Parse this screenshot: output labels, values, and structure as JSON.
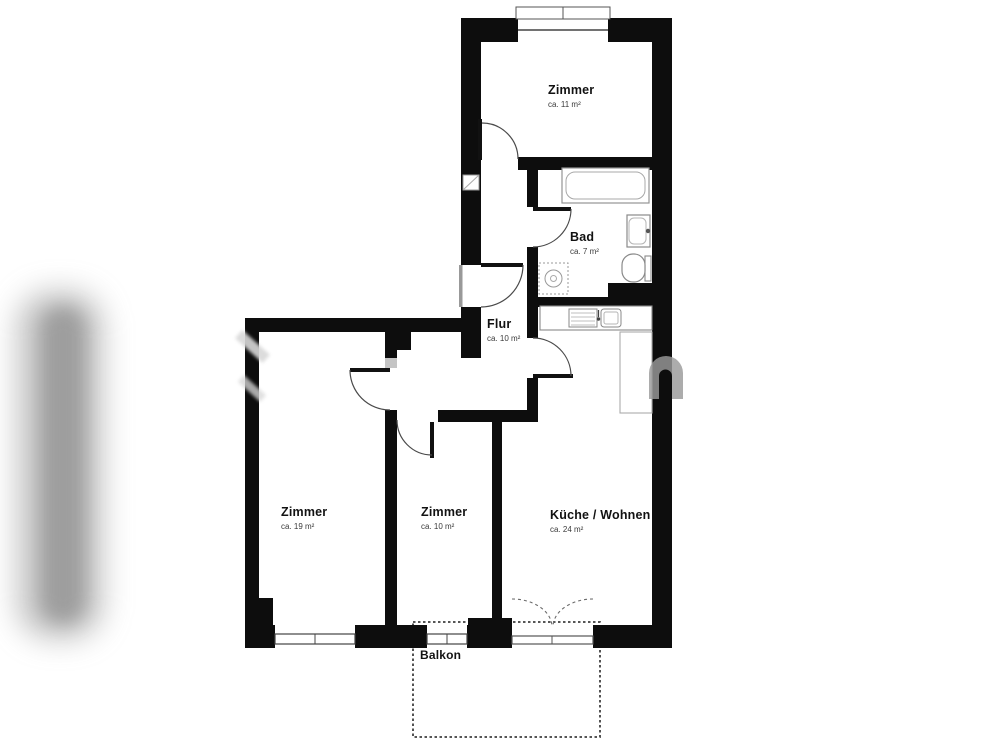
{
  "floorplan": {
    "rooms": [
      {
        "name": "Zimmer",
        "area": "ca. 11 m²"
      },
      {
        "name": "Bad",
        "area": "ca. 7 m²"
      },
      {
        "name": "Flur",
        "area": "ca. 10 m²"
      },
      {
        "name": "Zimmer",
        "area": "ca. 19 m²"
      },
      {
        "name": "Zimmer",
        "area": "ca. 10 m²"
      },
      {
        "name": "Küche / Wohnen",
        "area": "ca. 24 m²"
      },
      {
        "name": "Balkon",
        "area": ""
      }
    ],
    "colors": {
      "wall": "#0d0d0d",
      "fixture_outline": "#949494",
      "door_arc": "#4a4a4a",
      "balcony_dash": "#3f3f3f",
      "watermark": "#9a9a9a",
      "background": "#ffffff"
    }
  }
}
